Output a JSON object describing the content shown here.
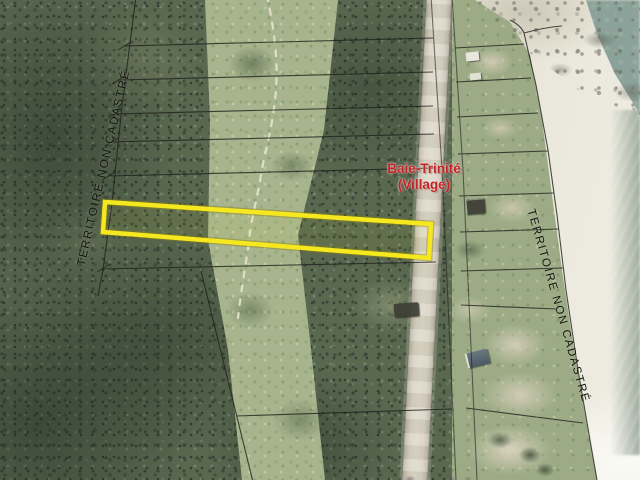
{
  "map": {
    "region_labels": {
      "territory_left": "TERRITOIRE NON CADASTRÉ",
      "territory_right": "TERRITOIRE NON CADASTRÉ"
    },
    "place_label": {
      "line1": "Baie-Trinité",
      "line2": "(Village)"
    },
    "colors": {
      "highlight_parcel_stroke": "#f6e81f",
      "place_label_red": "#c32222",
      "cadastral_line": "#20201c",
      "forest_green": "#5a6850",
      "clearing_green": "#a7b48d",
      "road_gray": "#d7d1c1",
      "beach_sand": "#e2ded0",
      "water_teal": "#8ba29a"
    }
  }
}
